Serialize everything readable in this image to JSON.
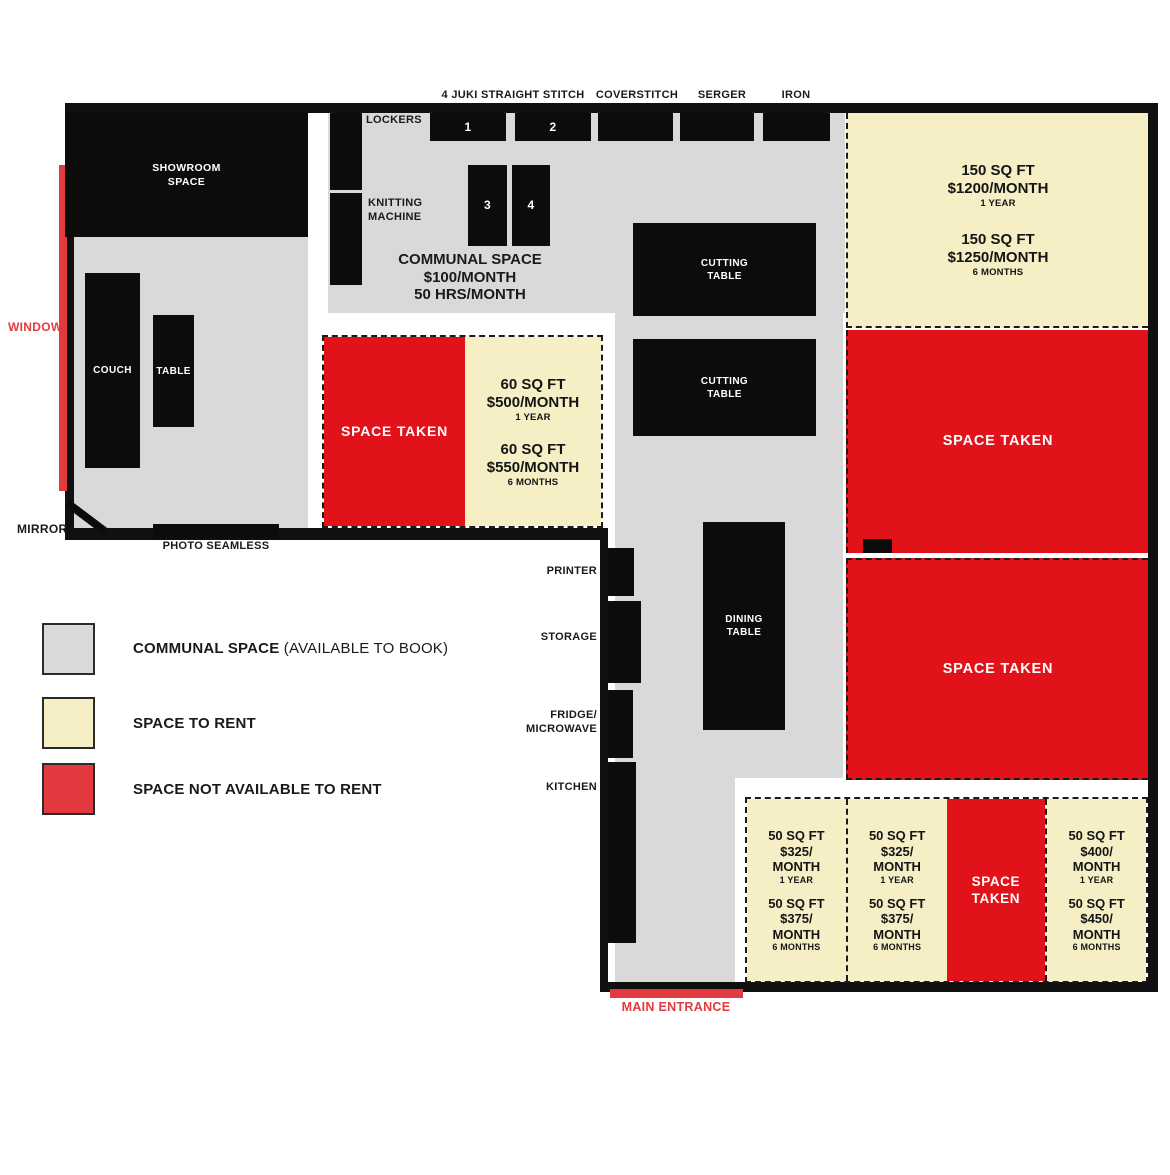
{
  "colors": {
    "communal": "#d9d9d9",
    "rent": "#f6efc6",
    "taken": "#e2121b",
    "window": "#e23a3e"
  },
  "labels": {
    "juki": "4 JUKI STRAIGHT STITCH",
    "coverstitch": "COVERSTITCH",
    "serger": "SERGER",
    "iron": "IRON",
    "lockers": "LOCKERS",
    "knitting_l1": "KNITTING",
    "knitting_l2": "MACHINE",
    "window": "WINDOW",
    "mirror": "MIRROR",
    "photo_seamless": "PHOTO SEAMLESS",
    "printer": "PRINTER",
    "storage": "STORAGE",
    "fridge_l1": "FRIDGE/",
    "fridge_l2": "MICROWAVE",
    "kitchen": "KITCHEN",
    "main_entrance": "MAIN ENTRANCE"
  },
  "furniture": {
    "showroom_l1": "SHOWROOM",
    "showroom_l2": "SPACE",
    "couch": "COUCH",
    "table": "TABLE",
    "cutting_l1": "CUTTING",
    "cutting_l2": "TABLE",
    "dining_l1": "DINING",
    "dining_l2": "TABLE",
    "m1": "1",
    "m2": "2",
    "m3": "3",
    "m4": "4"
  },
  "communal": {
    "l1": "COMMUNAL SPACE",
    "l2": "$100/MONTH",
    "l3": "50 HRS/MONTH"
  },
  "taken_label": "SPACE TAKEN",
  "rental_60": {
    "a": {
      "size": "60 SQ FT",
      "price": "$500/MONTH",
      "term": "1 YEAR"
    },
    "b": {
      "size": "60 SQ FT",
      "price": "$550/MONTH",
      "term": "6 MONTHS"
    }
  },
  "rental_150": {
    "a": {
      "size": "150 SQ FT",
      "price": "$1200/MONTH",
      "term": "1 YEAR"
    },
    "b": {
      "size": "150 SQ FT",
      "price": "$1250/MONTH",
      "term": "6 MONTHS"
    }
  },
  "cells": [
    {
      "type": "offers",
      "a": {
        "size": "50 SQ FT",
        "price": "$325/",
        "price2": "MONTH",
        "term": "1 YEAR"
      },
      "b": {
        "size": "50 SQ FT",
        "price": "$375/",
        "price2": "MONTH",
        "term": "6 MONTHS"
      }
    },
    {
      "type": "offers",
      "a": {
        "size": "50 SQ FT",
        "price": "$325/",
        "price2": "MONTH",
        "term": "1 YEAR"
      },
      "b": {
        "size": "50 SQ FT",
        "price": "$375/",
        "price2": "MONTH",
        "term": "6 MONTHS"
      }
    },
    {
      "type": "taken",
      "l1": "SPACE",
      "l2": "TAKEN"
    },
    {
      "type": "offers",
      "a": {
        "size": "50 SQ FT",
        "price": "$400/",
        "price2": "MONTH",
        "term": "1 YEAR"
      },
      "b": {
        "size": "50 SQ FT",
        "price": "$450/",
        "price2": "MONTH",
        "term": "6 MONTHS"
      }
    }
  ],
  "legend": {
    "communal_bold": "COMMUNAL SPACE",
    "communal_rest": "(AVAILABLE TO BOOK)",
    "rent": "SPACE TO RENT",
    "taken": "SPACE NOT AVAILABLE TO RENT"
  }
}
